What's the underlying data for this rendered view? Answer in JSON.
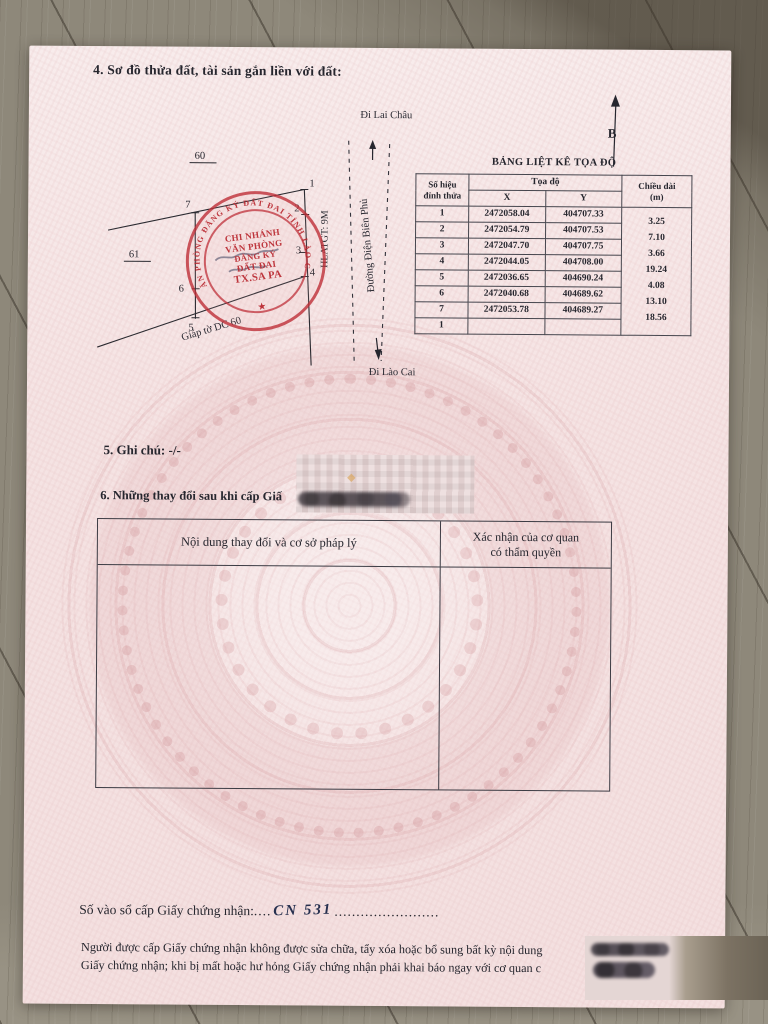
{
  "document": {
    "section4_title": "4. Sơ đồ thửa đất, tài sản gắn liền với đất:",
    "section5_title": "5. Ghi chú: -/-",
    "section6_title": "6. Những thay đổi sau khi cấp Giấ",
    "registry": {
      "label": "Số vào sổ cấp Giấy chứng nhận:",
      "leader_dots": "....",
      "number": "CN 531",
      "trailing_dots": "........................"
    },
    "footer_line1": "Người được cấp Giấy chứng nhận không được sửa chữa, tẩy xóa hoặc bổ sung bất kỳ nội dung",
    "footer_line2": "Giấy chứng nhận; khi bị mất hoặc hư hỏng Giấy chứng nhận phải khai báo ngay với cơ quan c"
  },
  "diagram": {
    "north_label": "B",
    "dest_top": "Đi Lai Châu",
    "dest_bottom": "Đi Lào Cai",
    "road_name": "Đường Điện Biên Phủ",
    "corridor_label": "HLATGT: 9M",
    "adjacent_parcel_label": "Giáp tờ DC 60",
    "parcel_left_top": "60",
    "parcel_left_bottom": "61",
    "v1": "1",
    "v2": "2",
    "v3": "3",
    "v4": "4",
    "v5": "5",
    "v6": "6",
    "v7": "7"
  },
  "stamp": {
    "ring_text": "VĂN PHÒNG ĐĂNG KÝ ĐẤT ĐAI TỈNH LÀO CAI",
    "center_line1": "CHI NHÁNH",
    "center_line2": "VĂN PHÒNG",
    "center_line3": "ĐĂNG KÝ",
    "center_line4": "ĐẤT ĐAI",
    "center_line5": "TX.SA PA",
    "star": "★"
  },
  "coordinate_table": {
    "title": "BẢNG LIỆT KÊ TỌA ĐỘ",
    "header_vertex_line1": "Số hiệu",
    "header_vertex_line2": "đỉnh thửa",
    "header_coord": "Tọa độ",
    "header_x": "X",
    "header_y": "Y",
    "header_length_line1": "Chiều dài",
    "header_length_line2": "(m)",
    "rows": [
      {
        "v": "1",
        "x": "2472058.04",
        "y": "404707.33"
      },
      {
        "v": "2",
        "x": "2472054.79",
        "y": "404707.53"
      },
      {
        "v": "3",
        "x": "2472047.70",
        "y": "404707.75"
      },
      {
        "v": "4",
        "x": "2472044.05",
        "y": "404708.00"
      },
      {
        "v": "5",
        "x": "2472036.65",
        "y": "404690.24"
      },
      {
        "v": "6",
        "x": "2472040.68",
        "y": "404689.62"
      },
      {
        "v": "7",
        "x": "2472053.78",
        "y": "404689.27"
      },
      {
        "v": "1",
        "x": "",
        "y": ""
      }
    ],
    "lengths": [
      "3.25",
      "7.10",
      "3.66",
      "19.24",
      "4.08",
      "13.10",
      "18.56"
    ]
  },
  "changes_table": {
    "col1_header": "Nội dung thay đổi và cơ sở pháp lý",
    "col2_header_line1": "Xác nhận của cơ quan",
    "col2_header_line2": "có thẩm quyền"
  },
  "colors": {
    "paper_pink": "#f5e3e3",
    "stamp_red": "#bd2a33",
    "ink": "#26262e",
    "handwriting_ink": "#27304f",
    "wood": "#8e887a"
  }
}
